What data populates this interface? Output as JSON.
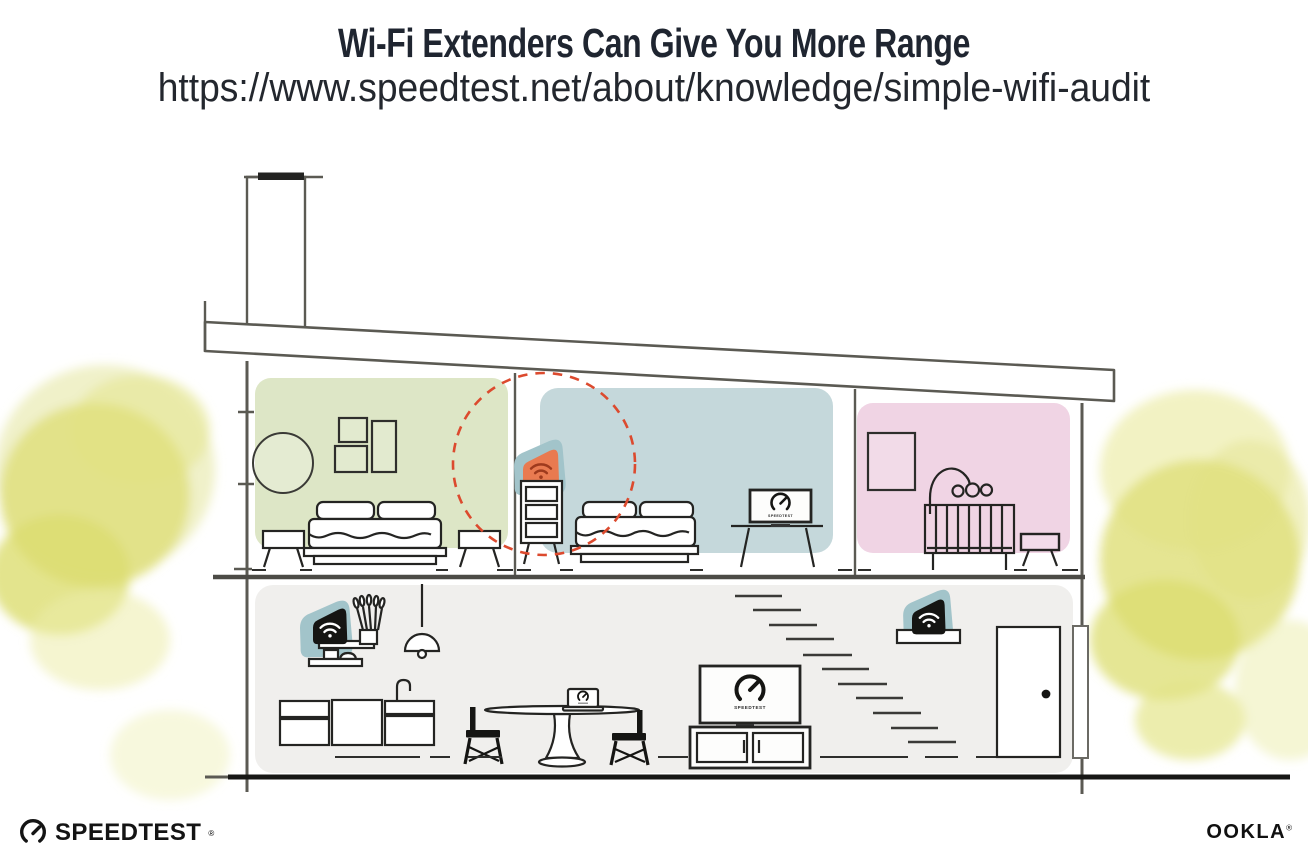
{
  "header": {
    "title": "Wi-Fi Extenders Can Give You More Range",
    "url": "https://www.speedtest.net/about/knowledge/simple-wifi-audit"
  },
  "illustration": {
    "speedtest_screen_label": "SPEEDTEST",
    "icons": [
      "wifi-icon",
      "speedtest-gauge-icon"
    ],
    "colors": {
      "room_green": "#dde6c6",
      "room_blue": "#c5d8db",
      "room_pink": "#f0d4e4",
      "ground_floor": "#f0efed",
      "device_teal": "#a2c4ca",
      "extender_orange": "#e97a50",
      "wifi_glyph_red": "#9e3a1d",
      "signal_circle": "#dc4a2e",
      "foliage_yellow": "#e0e17f",
      "foliage_yellow_light": "#eeefc3",
      "structure_line": "#5b5a53",
      "ink": "#1c1c1a"
    }
  },
  "footer": {
    "speedtest_wordmark": "SPEEDTEST",
    "ookla_wordmark": "OOKLA",
    "trademark": "®"
  }
}
